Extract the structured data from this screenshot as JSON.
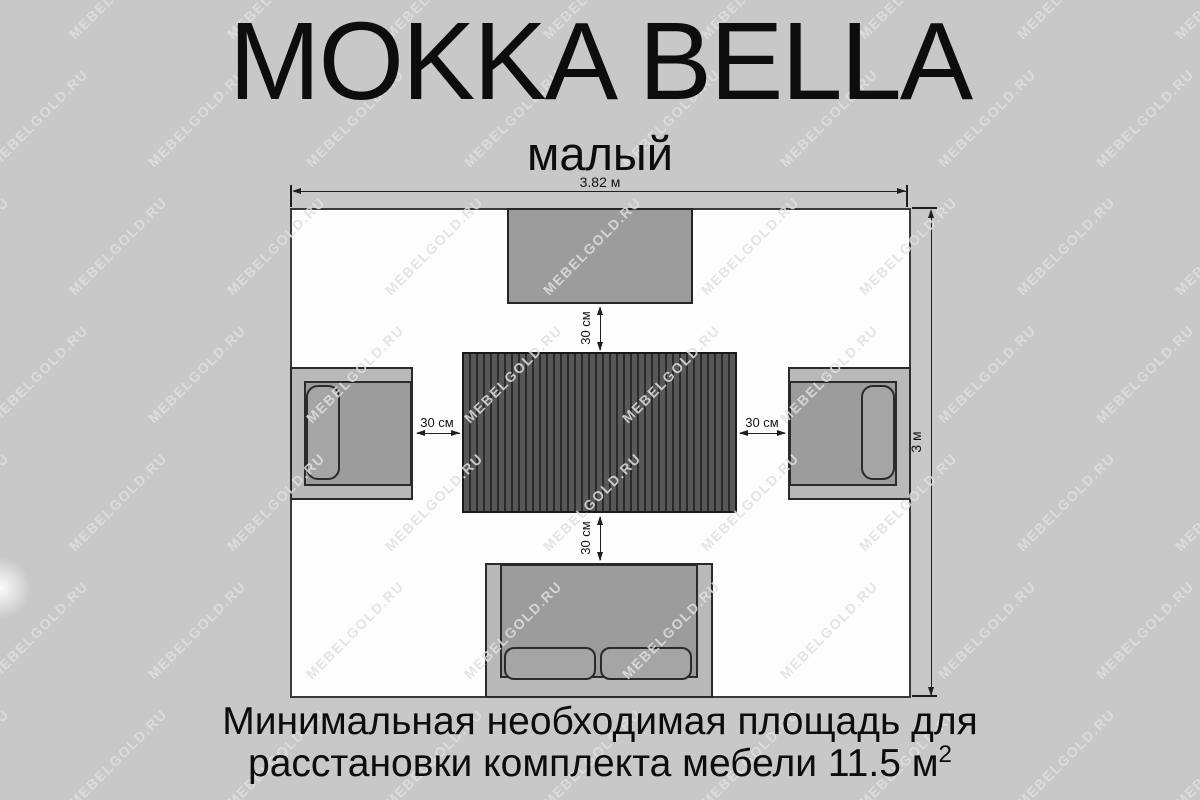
{
  "title": "MOKKA BELLA",
  "subtitle": "малый",
  "caption": {
    "line1": "Минимальная необходимая площадь для",
    "line2": "расстановки комплекта мебели 11.5 м",
    "superscript": "2"
  },
  "diagram": {
    "room_width_label": "3.82 м",
    "room_height_label": "3 м",
    "clearance_labels": {
      "top": "30 см",
      "left": "30 см",
      "right": "30 см",
      "bottom": "30 см"
    },
    "area_value": "11.5 м2"
  },
  "watermark": {
    "text": "MEBELGOLD.RU",
    "grid": {
      "cols": 9,
      "rows": 7,
      "dx": 158,
      "dy": 128,
      "x0": -40,
      "y0": -10,
      "stagger": 79
    }
  },
  "colors": {
    "background": "#c8c8c8",
    "room_fill": "#fdfdfd",
    "outline": "#2a2a2a",
    "furniture_frame": "#b9b9b9",
    "furniture_seat": "#9c9c9c",
    "cushion": "#a5a5a5",
    "table_slat_dark": "#2b2b2b",
    "table_slat_light": "#585858",
    "watermark": "#dfdfdf"
  }
}
